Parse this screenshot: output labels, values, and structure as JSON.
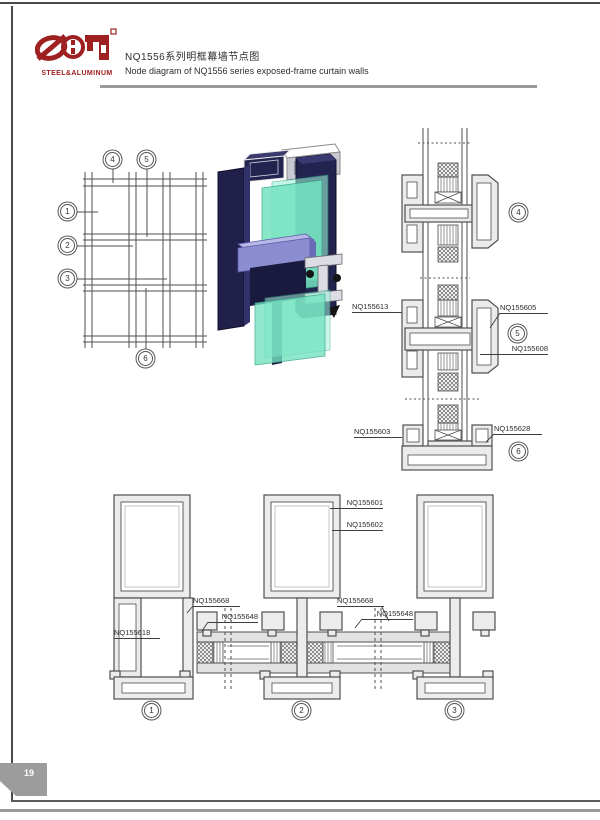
{
  "page": {
    "number": "19"
  },
  "header": {
    "logo_text": "STEEL&ALUMINUM",
    "title_cn": "NQ1556系列明框幕墙节点图",
    "title_en": "Node diagram of NQ1556 series exposed-frame curtain walls"
  },
  "colors": {
    "brand_red": "#9e2020",
    "tab_gray": "#9c9c9c",
    "line": "#4f4f4f"
  },
  "callouts": {
    "c1": "1",
    "c2": "2",
    "c3": "3",
    "c4": "4",
    "c5": "5",
    "c6": "6"
  },
  "part_labels": {
    "v_left_top": "NQ155613",
    "v_right_top": "NQ155605",
    "v_right_mid": "NQ155608",
    "v_left_bottom": "NQ155603",
    "v_right_bottom": "NQ155628",
    "h_mullion_outer": "NQ155601",
    "h_mullion_inner": "NQ155602",
    "h_pressure_plate_left": "NQ155668",
    "h_cover_left": "NQ155648",
    "h_pressure_plate_right": "NQ155668",
    "h_cover_right": "NQ155648",
    "h_end_cap": "NQ155618"
  }
}
